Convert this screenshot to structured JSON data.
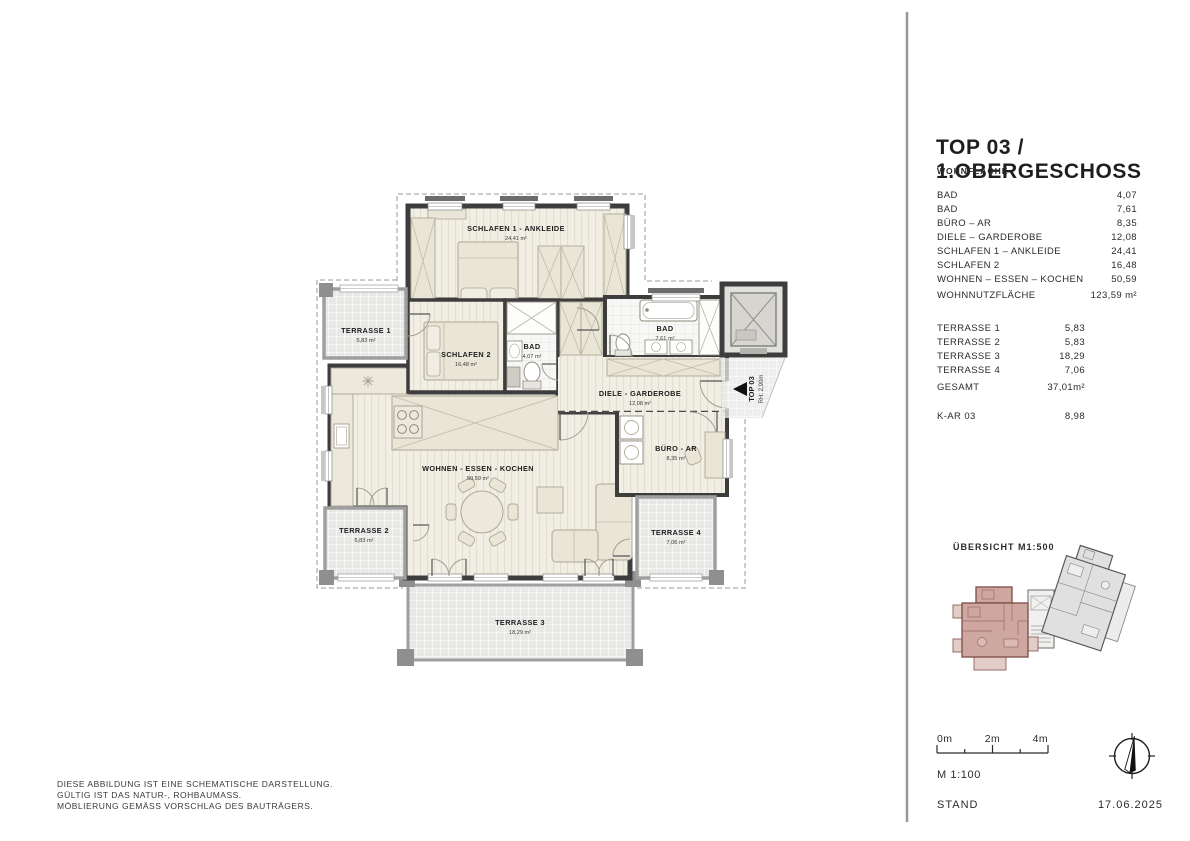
{
  "panel": {
    "title": "TOP 03 / 1.OBERGESCHOSS",
    "section1_heading": "WOHNFLÄCHE",
    "rooms": [
      {
        "label": "BAD",
        "value": "4,07"
      },
      {
        "label": "BAD",
        "value": "7,61"
      },
      {
        "label": "BÜRO – AR",
        "value": "8,35"
      },
      {
        "label": "DIELE – GARDEROBE",
        "value": "12,08"
      },
      {
        "label": "SCHLAFEN 1 – ANKLEIDE",
        "value": "24,41"
      },
      {
        "label": "SCHLAFEN 2",
        "value": "16,48"
      },
      {
        "label": "WOHNEN – ESSEN – KOCHEN",
        "value": "50,59"
      }
    ],
    "total_label": "WOHNNUTZFLÄCHE",
    "total_value": "123,59 m²",
    "terraces": [
      {
        "label": "TERRASSE 1",
        "value": "5,83"
      },
      {
        "label": "TERRASSE 2",
        "value": "5,83"
      },
      {
        "label": "TERRASSE 3",
        "value": "18,29"
      },
      {
        "label": "TERRASSE 4",
        "value": "7,06"
      }
    ],
    "gesamt_label": "GESAMT",
    "gesamt_value": "37,01m²",
    "kar_label": "K-AR 03",
    "kar_value": "8,98",
    "uebersicht_label": "ÜBERSICHT M1:500",
    "scale_0": "0m",
    "scale_2": "2m",
    "scale_4": "4m",
    "scale_text": "M 1:100",
    "stand_label": "STAND",
    "stand_date": "17.06.2025"
  },
  "plan": {
    "schlafen1": {
      "label": "SCHLAFEN 1 - ANKLEIDE",
      "area": "24,41 m²"
    },
    "schlafen2": {
      "label": "SCHLAFEN 2",
      "area": "16,48 m²"
    },
    "bad1": {
      "label": "BAD",
      "area": "4,07 m²"
    },
    "bad2": {
      "label": "BAD",
      "area": "7,61 m²"
    },
    "diele": {
      "label": "DIELE - GARDEROBE",
      "area": "12,08 m²"
    },
    "buero": {
      "label": "BÜRO - AR",
      "area": "8,35 m²"
    },
    "wohnen": {
      "label": "WOHNEN - ESSEN - KOCHEN",
      "area": "50,59 m²"
    },
    "terrasse1": {
      "label": "TERRASSE 1",
      "area": "5,83 m²"
    },
    "terrasse2": {
      "label": "TERRASSE 2",
      "area": "5,83 m²"
    },
    "terrasse3": {
      "label": "TERRASSE 3",
      "area": "18,29 m²"
    },
    "terrasse4": {
      "label": "TERRASSE 4",
      "area": "7,06 m²"
    },
    "entry_top": "TOP 03",
    "entry_rh": "RH: 2,90m"
  },
  "disclaimer": {
    "line1": "DIESE ABBILDUNG IST EINE SCHEMATISCHE DARSTELLUNG.",
    "line2": "GÜLTIG IST DAS NATUR-, ROHBAUMASS.",
    "line3": "MÖBLIERUNG GEMÄSS VORSCHLAG DES BAUTRÄGERS."
  },
  "colors": {
    "wall_dark": "#3d3d3d",
    "parapet_gray": "#9f9f9f",
    "floor_beige": "#f1eee3",
    "furniture_beige": "#e9e5d7",
    "terrace_gray": "#e8e8e6",
    "mini_pink": "#cfa7a1",
    "mini_pink_wall": "#7c4b43",
    "divider": "#989898"
  }
}
